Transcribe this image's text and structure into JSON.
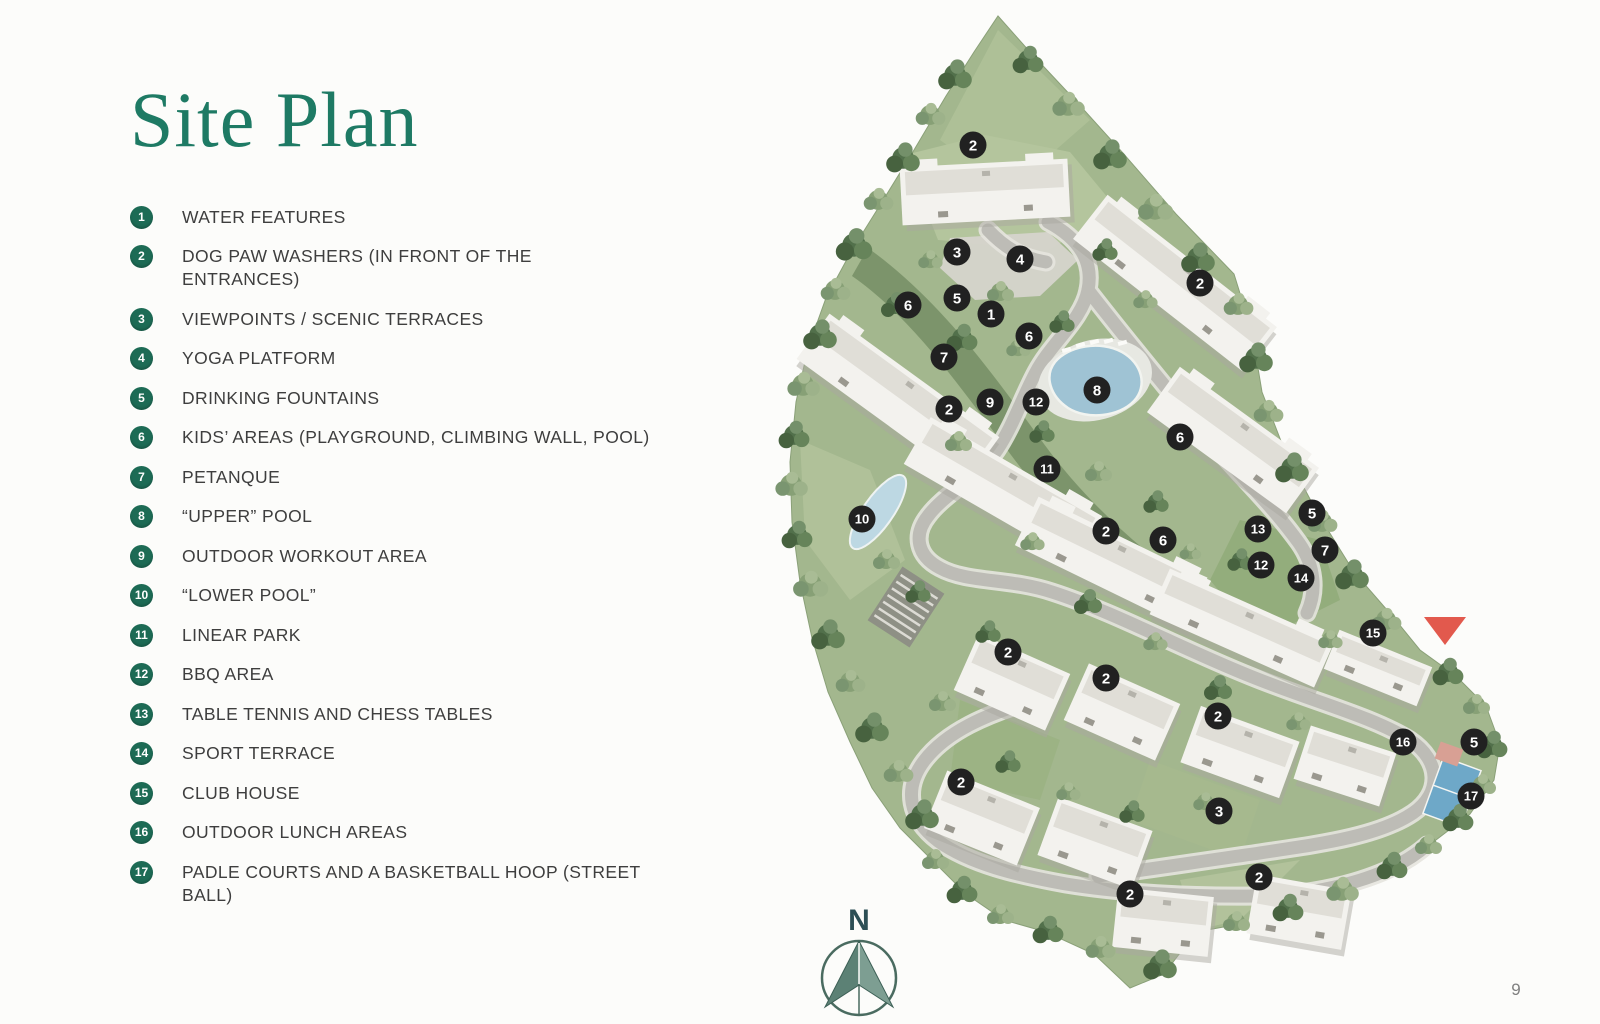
{
  "title": "Site Plan",
  "page_number": "9",
  "colors": {
    "title_green": "#1e7a64",
    "badge_green": "#1d6b55",
    "marker_black": "#212121",
    "entrance_red": "#e2594d",
    "compass_teal": "#5c8175"
  },
  "legend": {
    "items": [
      {
        "num": "1",
        "label": "WATER FEATURES"
      },
      {
        "num": "2",
        "label": "DOG PAW WASHERS (IN FRONT OF THE ENTRANCES)"
      },
      {
        "num": "3",
        "label": "VIEWPOINTS / SCENIC TERRACES"
      },
      {
        "num": "4",
        "label": "YOGA PLATFORM"
      },
      {
        "num": "5",
        "label": "DRINKING FOUNTAINS"
      },
      {
        "num": "6",
        "label": "KIDS’ AREAS (PLAYGROUND, CLIMBING WALL, POOL)"
      },
      {
        "num": "7",
        "label": "PETANQUE"
      },
      {
        "num": "8",
        "label": "“UPPER” POOL"
      },
      {
        "num": "9",
        "label": "OUTDOOR WORKOUT AREA"
      },
      {
        "num": "10",
        "label": "“LOWER POOL”"
      },
      {
        "num": "11",
        "label": "LINEAR PARK"
      },
      {
        "num": "12",
        "label": "BBQ AREA"
      },
      {
        "num": "13",
        "label": "TABLE TENNIS AND CHESS TABLES"
      },
      {
        "num": "14",
        "label": "SPORT TERRACE"
      },
      {
        "num": "15",
        "label": "CLUB HOUSE"
      },
      {
        "num": "16",
        "label": "OUTDOOR LUNCH AREAS"
      },
      {
        "num": "17",
        "label": "PADLE COURTS AND A BASKETBALL HOOP (STREET BALL)"
      }
    ]
  },
  "map": {
    "compass_label": "N",
    "entrance": {
      "x": 1445,
      "y": 617,
      "color": "#e2594d"
    },
    "markers": [
      {
        "n": "2",
        "x": 973,
        "y": 145
      },
      {
        "n": "3",
        "x": 957,
        "y": 252
      },
      {
        "n": "4",
        "x": 1020,
        "y": 259
      },
      {
        "n": "2",
        "x": 1200,
        "y": 283
      },
      {
        "n": "5",
        "x": 957,
        "y": 298
      },
      {
        "n": "6",
        "x": 908,
        "y": 305
      },
      {
        "n": "1",
        "x": 991,
        "y": 314
      },
      {
        "n": "6",
        "x": 1029,
        "y": 336
      },
      {
        "n": "7",
        "x": 944,
        "y": 357
      },
      {
        "n": "8",
        "x": 1097,
        "y": 390
      },
      {
        "n": "9",
        "x": 990,
        "y": 402
      },
      {
        "n": "12",
        "x": 1036,
        "y": 402
      },
      {
        "n": "2",
        "x": 949,
        "y": 409
      },
      {
        "n": "6",
        "x": 1180,
        "y": 437
      },
      {
        "n": "11",
        "x": 1047,
        "y": 469
      },
      {
        "n": "5",
        "x": 1312,
        "y": 513
      },
      {
        "n": "10",
        "x": 862,
        "y": 519
      },
      {
        "n": "13",
        "x": 1258,
        "y": 529
      },
      {
        "n": "2",
        "x": 1106,
        "y": 531
      },
      {
        "n": "6",
        "x": 1163,
        "y": 540
      },
      {
        "n": "7",
        "x": 1325,
        "y": 550
      },
      {
        "n": "12",
        "x": 1261,
        "y": 565
      },
      {
        "n": "14",
        "x": 1301,
        "y": 578
      },
      {
        "n": "15",
        "x": 1373,
        "y": 633
      },
      {
        "n": "2",
        "x": 1008,
        "y": 652
      },
      {
        "n": "2",
        "x": 1106,
        "y": 678
      },
      {
        "n": "2",
        "x": 1218,
        "y": 716
      },
      {
        "n": "16",
        "x": 1403,
        "y": 742
      },
      {
        "n": "5",
        "x": 1474,
        "y": 742
      },
      {
        "n": "2",
        "x": 961,
        "y": 782
      },
      {
        "n": "17",
        "x": 1471,
        "y": 796
      },
      {
        "n": "3",
        "x": 1219,
        "y": 811
      },
      {
        "n": "2",
        "x": 1259,
        "y": 877
      },
      {
        "n": "2",
        "x": 1130,
        "y": 894
      }
    ]
  }
}
